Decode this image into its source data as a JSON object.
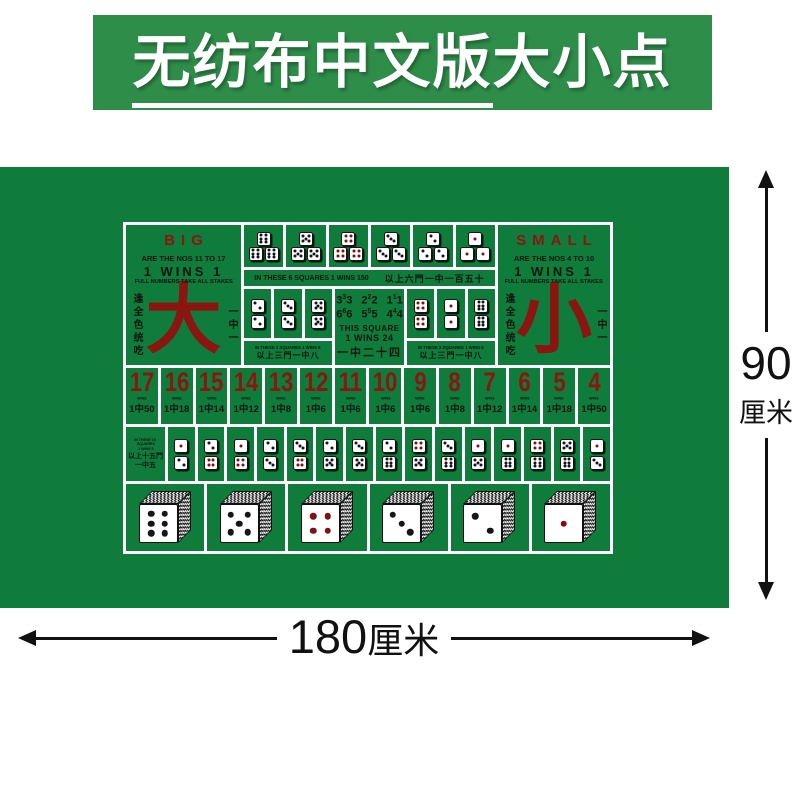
{
  "banner": {
    "title_underlined": "无纺布中文版",
    "title_rest": "大小点"
  },
  "mat": {
    "big": {
      "label": "BIG",
      "nos": "ARE THE NOS 11 TO 17",
      "wins": "1 WINS 1",
      "full": "FULL NUMBERS TAKE ALL STAKES",
      "hanzi": "大",
      "side_left": "逢全色统吃",
      "side_right": "一中一"
    },
    "small": {
      "label": "SMALL",
      "nos": "ARE THE NOS 4 TO 10",
      "wins": "1 WINS 1",
      "full": "FULL NUMBERS TAKE ALL STAKES",
      "hanzi": "小",
      "side_left": "逢全色统吃",
      "side_right": "一中一"
    },
    "triples": {
      "dice": [
        6,
        5,
        4,
        3,
        2,
        1
      ],
      "caption_en": "IN THESE 6 SQUARES 1 WINS 150",
      "caption_zh": "以上六門一中一百五十"
    },
    "doubles_left": {
      "dice": [
        2,
        3,
        5
      ],
      "caption_en": "IN THESE 3 SQUARES 1 WINS 8",
      "caption_zh": "以上三門一中八"
    },
    "doubles_right": {
      "dice": [
        4,
        1,
        6
      ],
      "caption_en": "IN THESE 3 SQUARES 1 WINS 8",
      "caption_zh": "以上三門一中八"
    },
    "any_triple": {
      "rows": [
        [
          "3",
          "2",
          "1"
        ],
        [
          "6",
          "5",
          "4"
        ]
      ],
      "line1": "THIS SQUARE",
      "line2": "1 WINS 24",
      "zh": "一中二十四"
    },
    "totals": {
      "wins_label": "WINS",
      "items": [
        {
          "n": "17",
          "odds": "1中50"
        },
        {
          "n": "16",
          "odds": "1中18"
        },
        {
          "n": "15",
          "odds": "1中14"
        },
        {
          "n": "14",
          "odds": "1中12"
        },
        {
          "n": "13",
          "odds": "1中8"
        },
        {
          "n": "12",
          "odds": "1中6"
        },
        {
          "n": "11",
          "odds": "1中6"
        },
        {
          "n": "10",
          "odds": "1中6"
        },
        {
          "n": "9",
          "odds": "1中6"
        },
        {
          "n": "8",
          "odds": "1中8"
        },
        {
          "n": "7",
          "odds": "1中12"
        },
        {
          "n": "6",
          "odds": "1中14"
        },
        {
          "n": "5",
          "odds": "1中18"
        },
        {
          "n": "4",
          "odds": "1中50"
        }
      ]
    },
    "combos": {
      "label_lines": [
        "IN THESE 15",
        "SQUARES",
        "1 WINS 5"
      ],
      "label_zh": [
        "以上十五門",
        "一中五"
      ],
      "pairs": [
        [
          1,
          2
        ],
        [
          2,
          4
        ],
        [
          1,
          4
        ],
        [
          2,
          3
        ],
        [
          3,
          4
        ],
        [
          2,
          5
        ],
        [
          3,
          5
        ],
        [
          2,
          6
        ],
        [
          4,
          5
        ],
        [
          3,
          6
        ],
        [
          1,
          5
        ],
        [
          1,
          6
        ],
        [
          4,
          6
        ],
        [
          5,
          6
        ],
        [
          1,
          3
        ]
      ]
    },
    "big_dice": [
      6,
      5,
      4,
      3,
      2,
      1
    ]
  },
  "dimensions": {
    "height_value": "90",
    "height_unit": "厘米",
    "width_value": "180",
    "width_unit": "厘米"
  },
  "colors": {
    "banner_green": "#2f8d4a",
    "mat_green": "#0f7c3c",
    "dark_red": "#8b1510",
    "pip_red": "#7c1216",
    "ink": "#10150f"
  }
}
